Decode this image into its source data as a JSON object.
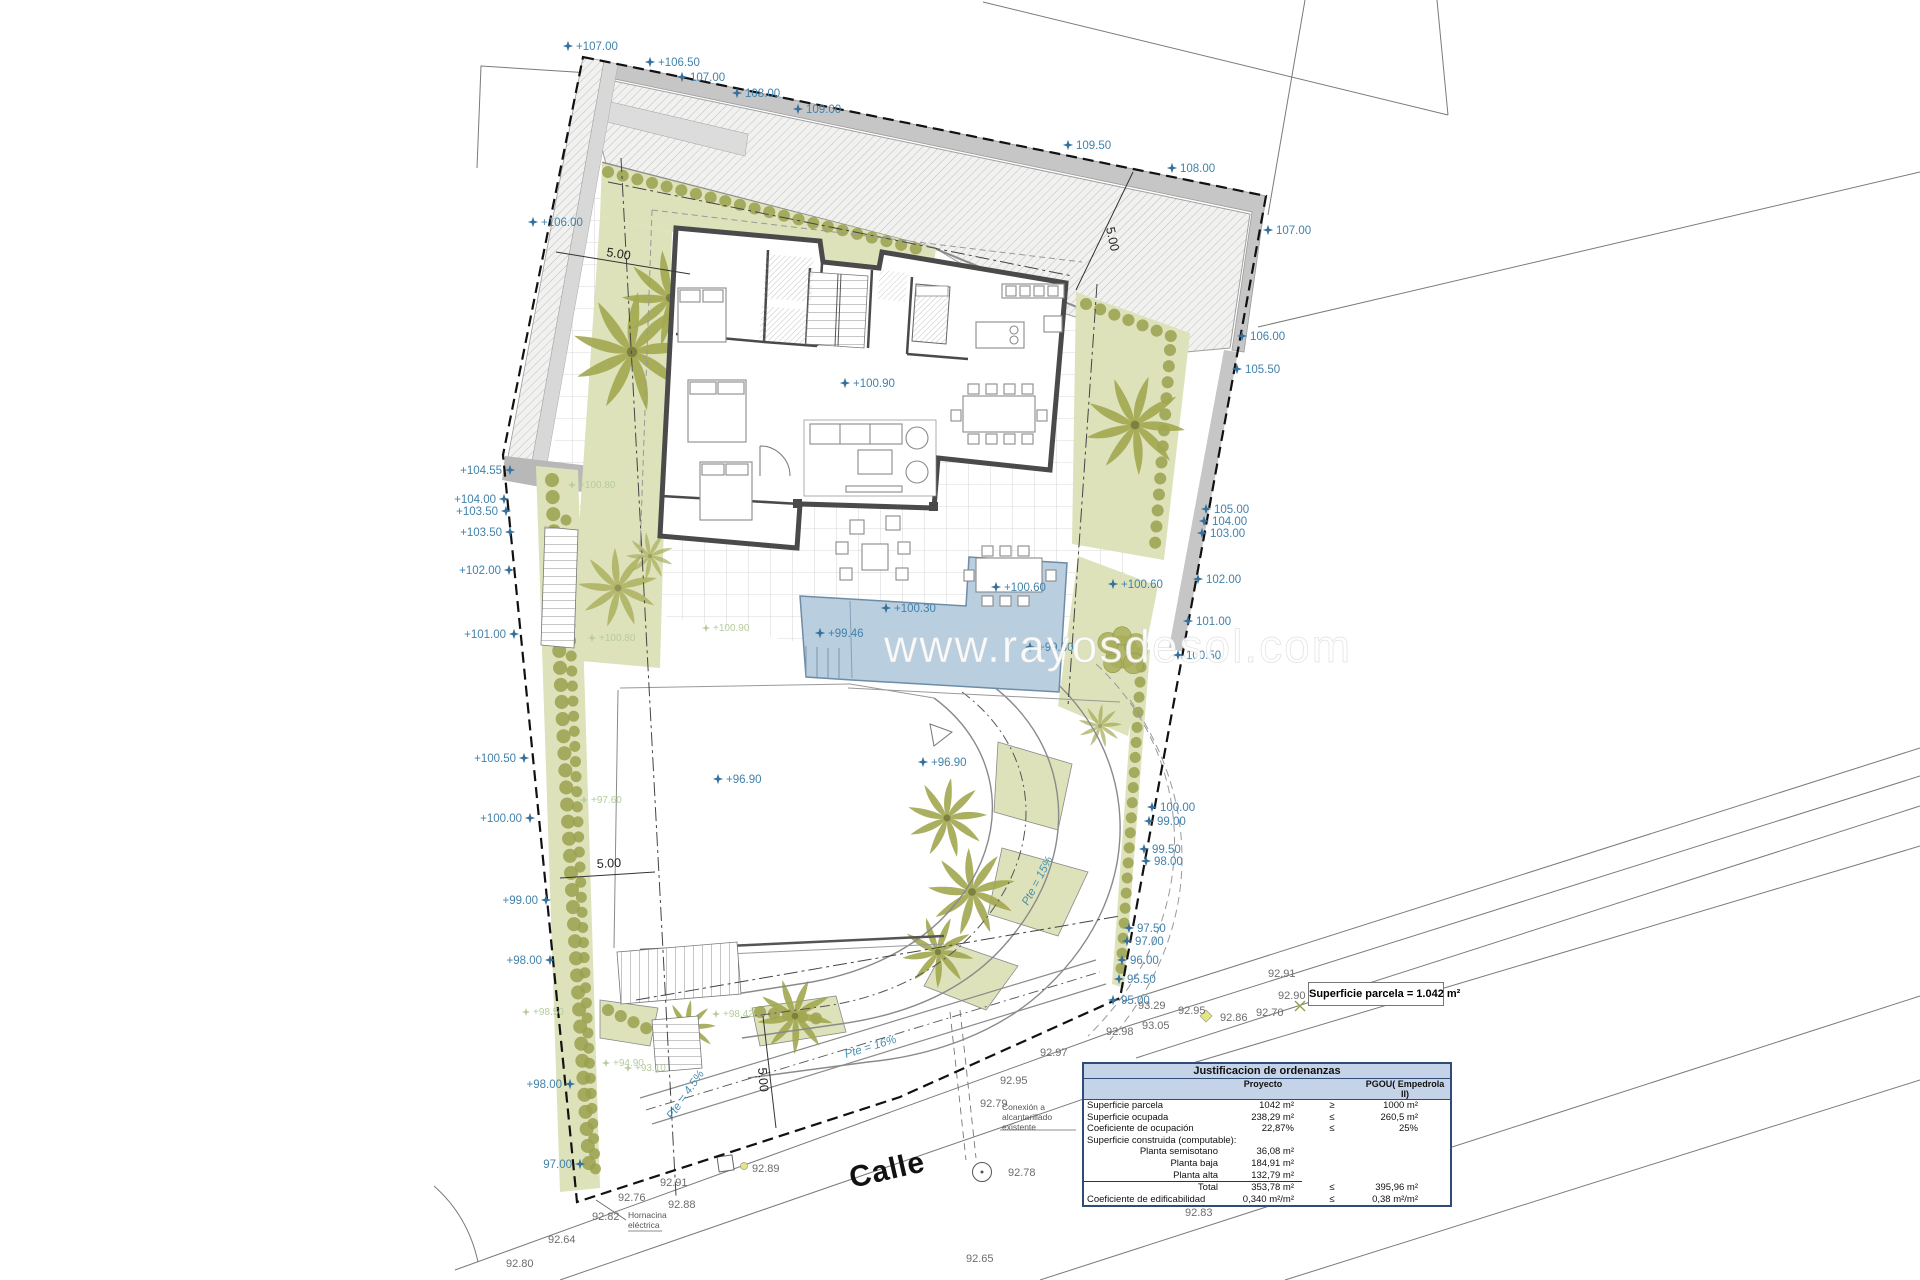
{
  "colors": {
    "marker_blue": "#35719c",
    "marker_text_blue": "#4282ab",
    "marker_green": "#b5cc9b",
    "street_gray": "#6d6d6d",
    "slope_teal": "#4a90b0",
    "dim_black": "#222222",
    "pool": "#b9cede",
    "garden": "#dde2ba",
    "palm": "#a2a750",
    "wall_gray": "#c6c6c6",
    "table_header": "#c5d3e8",
    "table_border": "#2f4b78"
  },
  "watermark": {
    "t": "www.rayosdesol.com",
    "x": 884,
    "y": 662
  },
  "street_name": {
    "t": "Calle",
    "x": 852,
    "y": 1188,
    "rot": -13
  },
  "parcel_box": "Superficie parcela = 1.042 m²",
  "table": {
    "title": "Justificacion de ordenanzas",
    "col_proyecto": "Proyecto",
    "col_pgou": "PGOU( Empedrola II)",
    "rows": [
      {
        "label": "Superficie parcela",
        "proyecto": "1042 m²",
        "sign": "≥",
        "pgou": "1000 m²",
        "cls": ""
      },
      {
        "label": "Superficie ocupada",
        "proyecto": "238,29 m²",
        "sign": "≤",
        "pgou": "260,5 m²",
        "cls": ""
      },
      {
        "label": "Coeficiente de ocupación",
        "proyecto": "22,87%",
        "sign": "≤",
        "pgou": "25%",
        "cls": ""
      },
      {
        "label": "Superficie construida (computable):",
        "proyecto": "",
        "sign": "",
        "pgou": "",
        "cls": ""
      },
      {
        "label": "Planta semisotano",
        "proyecto": "36,08 m²",
        "sign": "",
        "pgou": "",
        "cls": "indent"
      },
      {
        "label": "Planta baja",
        "proyecto": "184,91 m²",
        "sign": "",
        "pgou": "",
        "cls": "indent"
      },
      {
        "label": "Planta alta",
        "proyecto": "132,79 m²",
        "sign": "",
        "pgou": "",
        "cls": "indent underline"
      },
      {
        "label": "Total",
        "proyecto": "353,78 m²",
        "sign": "≤",
        "pgou": "395,96 m²",
        "cls": "indent"
      },
      {
        "label": "Coeficiente de edificabilidad",
        "proyecto": "0,340 m²/m²",
        "sign": "≤",
        "pgou": "0,38 m²/m²",
        "cls": ""
      }
    ]
  },
  "annotations": {
    "site_markers": [
      {
        "x": 568,
        "y": 46,
        "t": "+107.00",
        "s": "R"
      },
      {
        "x": 650,
        "y": 62,
        "t": "+106.50",
        "s": "R"
      },
      {
        "x": 682,
        "y": 77,
        "t": "107.00",
        "s": "R"
      },
      {
        "x": 737,
        "y": 93,
        "t": "108.00",
        "s": "R"
      },
      {
        "x": 798,
        "y": 109,
        "t": "109.00",
        "s": "R"
      },
      {
        "x": 1068,
        "y": 145,
        "t": "109.50",
        "s": "R"
      },
      {
        "x": 1172,
        "y": 168,
        "t": "108.00",
        "s": "R"
      },
      {
        "x": 1268,
        "y": 230,
        "t": "107.00",
        "s": "R"
      },
      {
        "x": 1242,
        "y": 336,
        "t": "106.00",
        "s": "R"
      },
      {
        "x": 1237,
        "y": 369,
        "t": "105.50",
        "s": "R"
      },
      {
        "x": 1206,
        "y": 509,
        "t": "105.00",
        "s": "R"
      },
      {
        "x": 1204,
        "y": 521,
        "t": "104.00",
        "s": "R"
      },
      {
        "x": 1202,
        "y": 533,
        "t": "103.00",
        "s": "R"
      },
      {
        "x": 1198,
        "y": 579,
        "t": "102.00",
        "s": "R"
      },
      {
        "x": 1188,
        "y": 621,
        "t": "101.00",
        "s": "R"
      },
      {
        "x": 1178,
        "y": 655,
        "t": "100.50",
        "s": "R"
      },
      {
        "x": 1152,
        "y": 807,
        "t": "100.00",
        "s": "R"
      },
      {
        "x": 1149,
        "y": 821,
        "t": "99.00",
        "s": "R"
      },
      {
        "x": 1144,
        "y": 849,
        "t": "99.50",
        "s": "R"
      },
      {
        "x": 1146,
        "y": 861,
        "t": "98.00",
        "s": "R"
      },
      {
        "x": 1129,
        "y": 928,
        "t": "97.50",
        "s": "R"
      },
      {
        "x": 1127,
        "y": 941,
        "t": "97.00",
        "s": "R"
      },
      {
        "x": 1122,
        "y": 960,
        "t": "96.00",
        "s": "R"
      },
      {
        "x": 1119,
        "y": 979,
        "t": "95.50",
        "s": "R"
      },
      {
        "x": 1113,
        "y": 1000,
        "t": "95.00",
        "s": "R"
      },
      {
        "x": 533,
        "y": 222,
        "t": "+106.00",
        "s": "R"
      },
      {
        "x": 510,
        "y": 470,
        "t": "+104.55",
        "s": "L"
      },
      {
        "x": 504,
        "y": 499,
        "t": "+104.00",
        "s": "L"
      },
      {
        "x": 506,
        "y": 511,
        "t": "+103.50",
        "s": "L"
      },
      {
        "x": 510,
        "y": 532,
        "t": "+103.50",
        "s": "L"
      },
      {
        "x": 509,
        "y": 570,
        "t": "+102.00",
        "s": "L"
      },
      {
        "x": 514,
        "y": 634,
        "t": "+101.00",
        "s": "L"
      },
      {
        "x": 524,
        "y": 758,
        "t": "+100.50",
        "s": "L"
      },
      {
        "x": 530,
        "y": 818,
        "t": "+100.00",
        "s": "L"
      },
      {
        "x": 546,
        "y": 900,
        "t": "+99.00",
        "s": "L"
      },
      {
        "x": 550,
        "y": 960,
        "t": "+98.00",
        "s": "L"
      },
      {
        "x": 570,
        "y": 1084,
        "t": "+98.00",
        "s": "L"
      },
      {
        "x": 580,
        "y": 1164,
        "t": "97.00",
        "s": "L"
      },
      {
        "x": 820,
        "y": 633,
        "t": "+99.46",
        "s": "R"
      },
      {
        "x": 886,
        "y": 608,
        "t": "+100.30",
        "s": "R"
      },
      {
        "x": 996,
        "y": 587,
        "t": "+100.60",
        "s": "R"
      },
      {
        "x": 1030,
        "y": 647,
        "t": "+99.30",
        "s": "R"
      },
      {
        "x": 1113,
        "y": 584,
        "t": "+100.60",
        "s": "R"
      },
      {
        "x": 718,
        "y": 779,
        "t": "+96.90",
        "s": "R"
      },
      {
        "x": 923,
        "y": 762,
        "t": "+96.90",
        "s": "R"
      },
      {
        "x": 845,
        "y": 383,
        "t": "+100.90",
        "s": "R"
      }
    ],
    "green_markers": [
      {
        "x": 572,
        "y": 485,
        "t": "+100.80"
      },
      {
        "x": 592,
        "y": 638,
        "t": "+100.80"
      },
      {
        "x": 706,
        "y": 628,
        "t": "+100.90"
      },
      {
        "x": 584,
        "y": 800,
        "t": "+97.60"
      },
      {
        "x": 526,
        "y": 1012,
        "t": "+98.50"
      },
      {
        "x": 606,
        "y": 1063,
        "t": "+94.90"
      },
      {
        "x": 628,
        "y": 1068,
        "t": "+93.10"
      },
      {
        "x": 716,
        "y": 1014,
        "t": "+98.42"
      }
    ],
    "street_levels": [
      {
        "x": 548,
        "y": 1243,
        "t": "92.64"
      },
      {
        "x": 506,
        "y": 1267,
        "t": "92.80"
      },
      {
        "x": 592,
        "y": 1220,
        "t": "92.82"
      },
      {
        "x": 618,
        "y": 1201,
        "t": "92.76"
      },
      {
        "x": 668,
        "y": 1208,
        "t": "92.88"
      },
      {
        "x": 660,
        "y": 1186,
        "t": "92.91"
      },
      {
        "x": 752,
        "y": 1172,
        "t": "92.89"
      },
      {
        "x": 980,
        "y": 1107,
        "t": "92.79"
      },
      {
        "x": 1000,
        "y": 1084,
        "t": "92.95"
      },
      {
        "x": 1040,
        "y": 1056,
        "t": "92.97"
      },
      {
        "x": 1106,
        "y": 1035,
        "t": "92.98"
      },
      {
        "x": 1008,
        "y": 1176,
        "t": "92.78"
      },
      {
        "x": 1142,
        "y": 1029,
        "t": "93.05"
      },
      {
        "x": 1138,
        "y": 1009,
        "t": "93.29"
      },
      {
        "x": 1178,
        "y": 1014,
        "t": "92.95"
      },
      {
        "x": 1220,
        "y": 1021,
        "t": "92.86"
      },
      {
        "x": 1256,
        "y": 1016,
        "t": "92.70"
      },
      {
        "x": 1278,
        "y": 999,
        "t": "92.90"
      },
      {
        "x": 1268,
        "y": 977,
        "t": "92.91"
      },
      {
        "x": 1185,
        "y": 1216,
        "t": "92.83"
      },
      {
        "x": 966,
        "y": 1262,
        "t": "92.65"
      }
    ],
    "slope_labels": [
      {
        "t": "Pte = 15%",
        "x": 1028,
        "y": 906,
        "rot": -62
      },
      {
        "t": "Pte = 16%",
        "x": 846,
        "y": 1058,
        "rot": -17
      },
      {
        "t": "Pte = 4.5%",
        "x": 672,
        "y": 1120,
        "rot": -55
      }
    ],
    "dimension_labels": [
      {
        "t": "5.00",
        "x": 606,
        "y": 256,
        "rot": 9
      },
      {
        "t": "5.00",
        "x": 1106,
        "y": 228,
        "rot": 78
      },
      {
        "t": "5.00",
        "x": 597,
        "y": 868,
        "rot": -3
      },
      {
        "t": "5.00",
        "x": 758,
        "y": 1068,
        "rot": 85
      }
    ],
    "notes": {
      "hornacina": {
        "x": 628,
        "y": 1218,
        "lines": [
          "Hornacina",
          "eléctrica"
        ]
      },
      "sewer": {
        "x": 1002,
        "y": 1110,
        "lines": [
          "Conexión a",
          "alcantarillado",
          "existente"
        ]
      }
    }
  }
}
